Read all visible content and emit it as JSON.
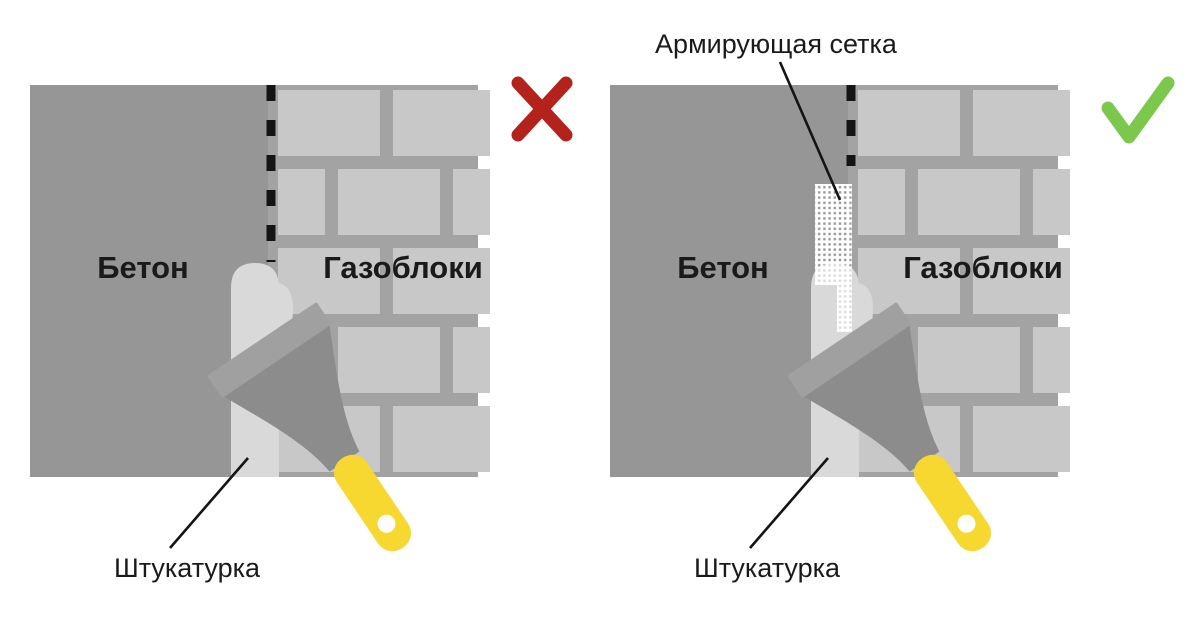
{
  "diagram_title": "",
  "colors": {
    "background": "#ffffff",
    "concrete": "#969696",
    "mortar": "#a3a3a3",
    "brick": "#c8c8c8",
    "plaster": "#d9d9d9",
    "blade": "#8c8c8c",
    "blade_band": "#a0a0a0",
    "handle": "#f7d830",
    "mesh": "#ffffff",
    "cross": "#b3231c",
    "check": "#7cc84c",
    "line": "#141414",
    "text": "#1a1a1a"
  },
  "panels": [
    {
      "side": "left",
      "verdict": "wrong",
      "verdict_icon": "cross-icon",
      "has_mesh": false,
      "labels": {
        "concrete": "Бетон",
        "gasblocks": "Газоблоки",
        "plaster": "Штукатурка"
      }
    },
    {
      "side": "right",
      "verdict": "correct",
      "verdict_icon": "checkmark-icon",
      "has_mesh": true,
      "labels": {
        "concrete": "Бетон",
        "gasblocks": "Газоблоки",
        "plaster": "Штукатурка",
        "mesh": "Армирующая сетка"
      }
    }
  ]
}
